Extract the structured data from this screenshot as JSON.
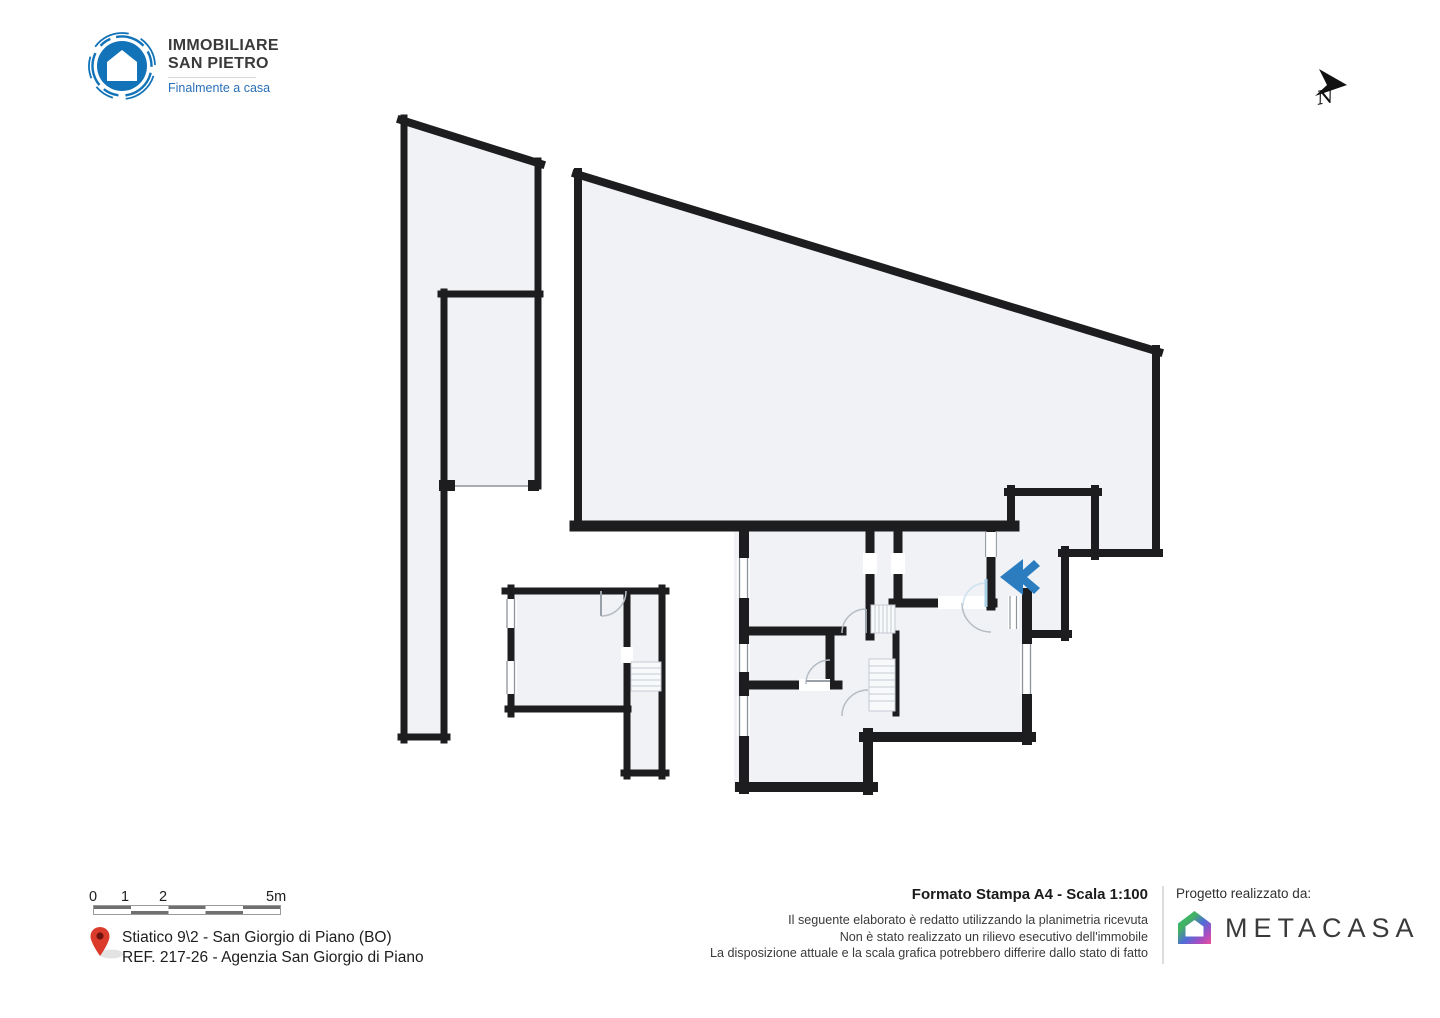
{
  "brand": {
    "line1": "IMMOBILIARE",
    "line2": "SAN PIETRO",
    "tagline": "Finalmente a casa"
  },
  "compass": {
    "label": "N"
  },
  "scale_bar": {
    "zero": "0",
    "one": "1",
    "two": "2",
    "five": "5m"
  },
  "address": {
    "line1": "Stiatico 9\\2 - San Giorgio di Piano (BO)",
    "line2": "REF. 217-26 - Agenzia San Giorgio di Piano"
  },
  "print_info": {
    "title": "Formato Stampa A4 - Scala 1:100",
    "disclaimer1": "Il seguente elaborato è redatto utilizzando la planimetria ricevuta",
    "disclaimer2": "Non è stato realizzato un rilievo esecutivo dell'immobile",
    "disclaimer3": "La disposizione attuale e la scala grafica potrebbero differire dallo stato di fatto"
  },
  "credits": {
    "label": "Progetto realizzato da:",
    "brand": "METACASA"
  },
  "icons": {
    "logo": "house-in-circle",
    "north": "north-arrow",
    "entrance": "double-chevron-left",
    "pin": "location-pin",
    "metacasa": "gradient-house"
  },
  "colors": {
    "logo_blue": "#1273b8",
    "tagline_blue": "#2a70b8",
    "wall": "#1d1d1f",
    "room_fill": "#f0f2f5",
    "chevron_blue": "#2b7dc0",
    "pin_red": "#d93a2b",
    "scale_gray": "#6f6f6f",
    "text_dark": "#1b1b1b"
  }
}
